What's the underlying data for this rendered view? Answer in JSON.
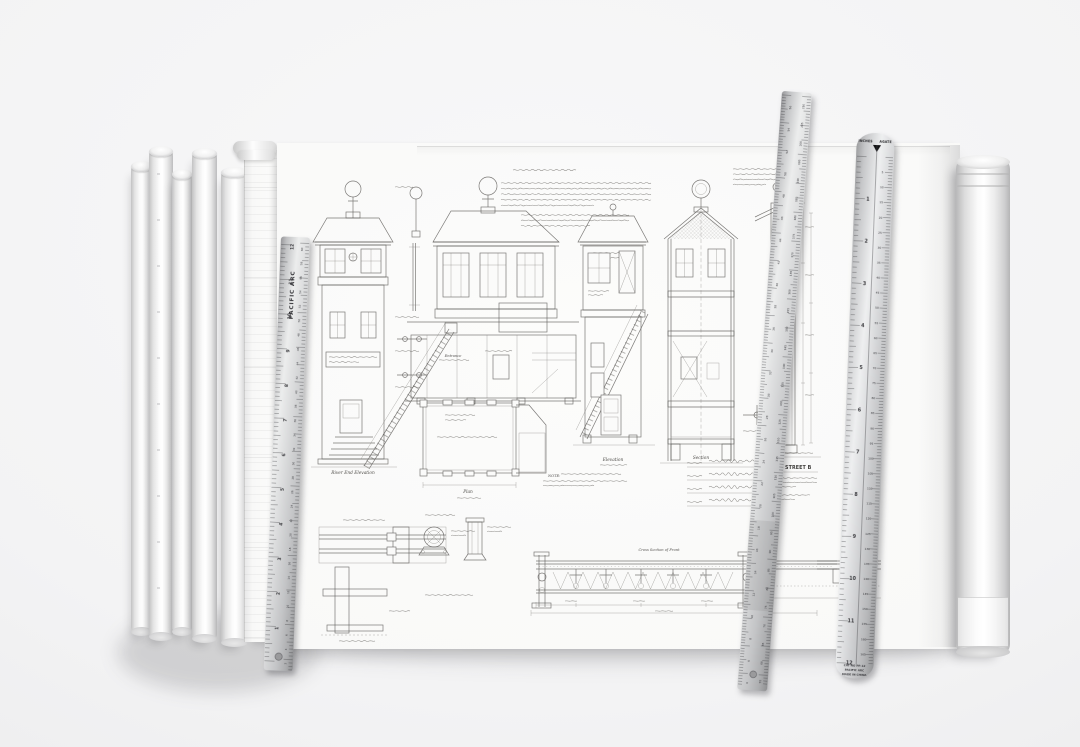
{
  "scene": {
    "description": "Hand-drawn railway signal-box blueprint sheet lying on a table with rolled plan sheets at left and right and two Pacific Arc drafting rulers laid across it"
  },
  "sheet": {
    "labels": {
      "river_end_elevation": "River End Elevation",
      "entrance": "Entrance",
      "plan": "Plan",
      "elevation": "Elevation",
      "section": "Section",
      "cross_section_of_front": "Cross Section of Front",
      "note": "NOTE:",
      "title_block_title": "ROMA STREET B"
    }
  },
  "rulers": {
    "left": {
      "brand": "PACIFIC ARC",
      "inch_numbers": [
        12,
        11,
        10,
        9,
        8,
        7,
        6,
        5,
        4,
        3,
        2,
        1
      ],
      "metric_numbers": [
        60,
        58,
        56,
        54,
        52,
        50,
        48,
        46,
        44,
        42,
        40,
        38,
        36,
        34,
        32,
        30,
        28,
        26,
        24,
        22,
        20,
        18,
        16,
        14,
        12,
        10,
        8,
        6,
        4,
        2
      ]
    },
    "diagonal": {
      "left_numbers": [
        56,
        54,
        52,
        50,
        48,
        46,
        44,
        42,
        40,
        38,
        36,
        34,
        32,
        30,
        28,
        26,
        24,
        22,
        20,
        18,
        16,
        14,
        12,
        10,
        8,
        6,
        4
      ],
      "right_numbers": [
        210,
        205,
        200,
        195,
        190,
        185,
        180,
        175,
        170,
        165,
        160,
        155,
        150,
        145,
        140,
        135,
        130,
        125,
        120,
        115,
        110,
        105,
        100,
        95,
        90,
        85,
        80,
        75,
        70,
        65,
        60,
        55
      ]
    },
    "pica": {
      "header_left": "INCHES",
      "header_right": "AGATE",
      "inch_numbers": [
        1,
        2,
        3,
        4,
        5,
        6,
        7,
        8,
        9,
        10,
        11,
        12
      ],
      "agate_numbers": [
        5,
        10,
        15,
        20,
        25,
        30,
        35,
        40,
        45,
        50,
        55,
        60,
        65,
        70,
        75,
        80,
        85,
        90,
        95,
        100,
        105,
        110,
        115,
        120,
        125,
        130,
        135,
        140,
        145,
        150,
        155,
        160,
        165
      ],
      "footer_lines": [
        "CAT NO PP-12",
        "PACIFIC ARC",
        "MADE IN CHINA"
      ]
    }
  }
}
